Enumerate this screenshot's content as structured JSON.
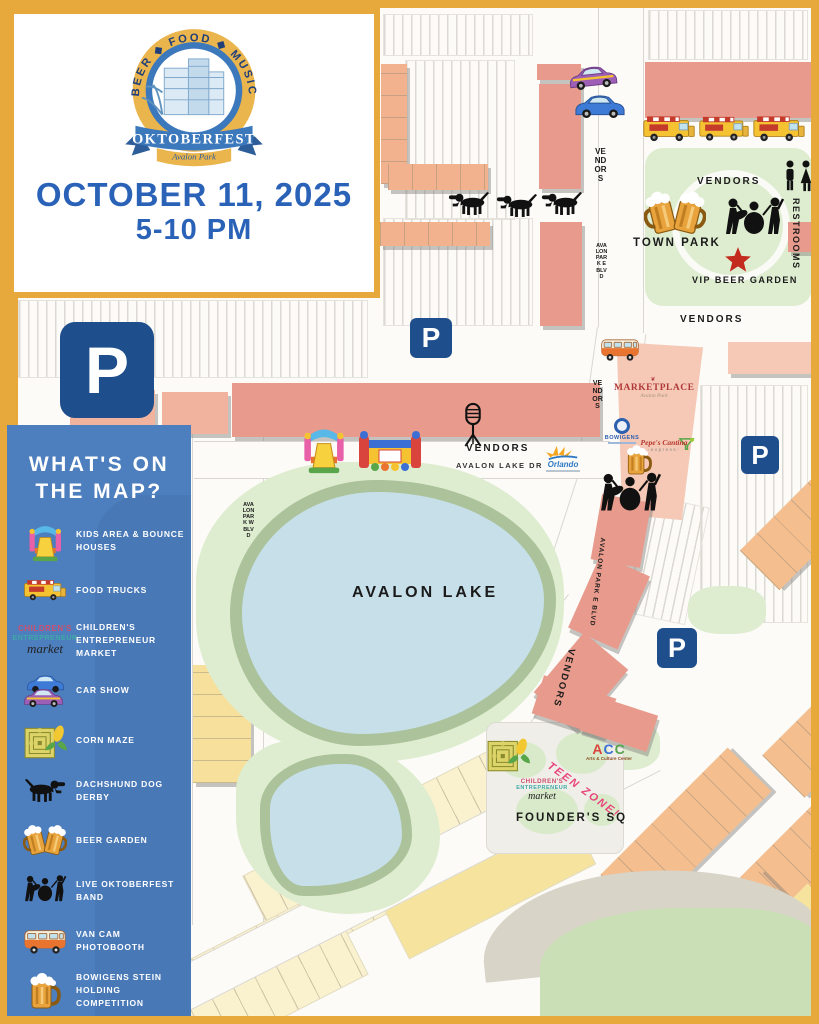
{
  "event": {
    "tagline": "BEER ◆ FOOD ◆ MUSIC",
    "title": "OKTOBERFEST",
    "subtitle": "Avalon Park",
    "date": "OCTOBER 11, 2025",
    "time": "5-10 PM"
  },
  "legend": {
    "title_line1": "WHAT'S ON",
    "title_line2": "THE MAP?",
    "items": [
      {
        "icon": "bounce-house-icon",
        "label": "KIDS AREA & BOUNCE\nHOUSES"
      },
      {
        "icon": "food-truck-icon",
        "label": "FOOD TRUCKS"
      },
      {
        "icon": "childrens-market-logo",
        "label": "CHILDREN'S\nENTREPRENEUR MARKET"
      },
      {
        "icon": "car-show-icon",
        "label": "CAR SHOW"
      },
      {
        "icon": "corn-maze-icon",
        "label": "CORN MAZE"
      },
      {
        "icon": "dachshund-icon",
        "label": "DACHSHUND DOG DERBY"
      },
      {
        "icon": "beer-garden-icon",
        "label": "BEER GARDEN"
      },
      {
        "icon": "live-band-icon",
        "label": "LIVE OKTOBERFEST BAND"
      },
      {
        "icon": "van-photobooth-icon",
        "label": "VAN CAM PHOTOBOOTH"
      },
      {
        "icon": "stein-icon",
        "label": "BOWIGENS STEIN\nHOLDING COMPETITION"
      },
      {
        "icon": "karaoke-mic-icon",
        "label": "KARAOKE AT BRAZAS\n9 PM - MIDNIGHT"
      }
    ]
  },
  "map": {
    "labels": {
      "vendors": "VENDORS",
      "town_park": "TOWN PARK",
      "vip_beer_garden": "VIP BEER GARDEN",
      "restrooms": "RESTROOMS",
      "avalon_park_e_blvd": "AVALON PARK E BLVD",
      "avalon_park_w_blvd": "AVALON PARK W BLVD",
      "avalon_lake_dr": "AVALON LAKE DR",
      "avalon_lake": "AVALON LAKE",
      "founders_sq": "FOUNDER'S SQ",
      "teen_zone": "TEEN ZONE!",
      "parking": "P"
    },
    "logos": {
      "marketplace": {
        "name": "MARKETPLACE",
        "sub": "Avalon Park"
      },
      "bowigens": {
        "name": "BOWIGENS"
      },
      "pepes": {
        "name": "Pepe's Cantina",
        "sub": "-express-"
      },
      "orlando": {
        "name": "Orlando"
      },
      "acc": {
        "a": "A",
        "c1": "C",
        "c2": "C",
        "sub": "Arts & Culture Center"
      },
      "childrens_market": {
        "line1": "CHILDREN'S",
        "line2": "ENTREPRENEUR",
        "line3": "market"
      }
    }
  },
  "colors": {
    "frame_gold": "#E8A93C",
    "sidebar_blue": "#4D7EBD",
    "heading_blue": "#2A62B8",
    "parking_navy": "#1F4E8C",
    "star_red": "#C42B1F",
    "park_green": "#DEEDD0",
    "lake_blue": "#C6DFE9"
  }
}
